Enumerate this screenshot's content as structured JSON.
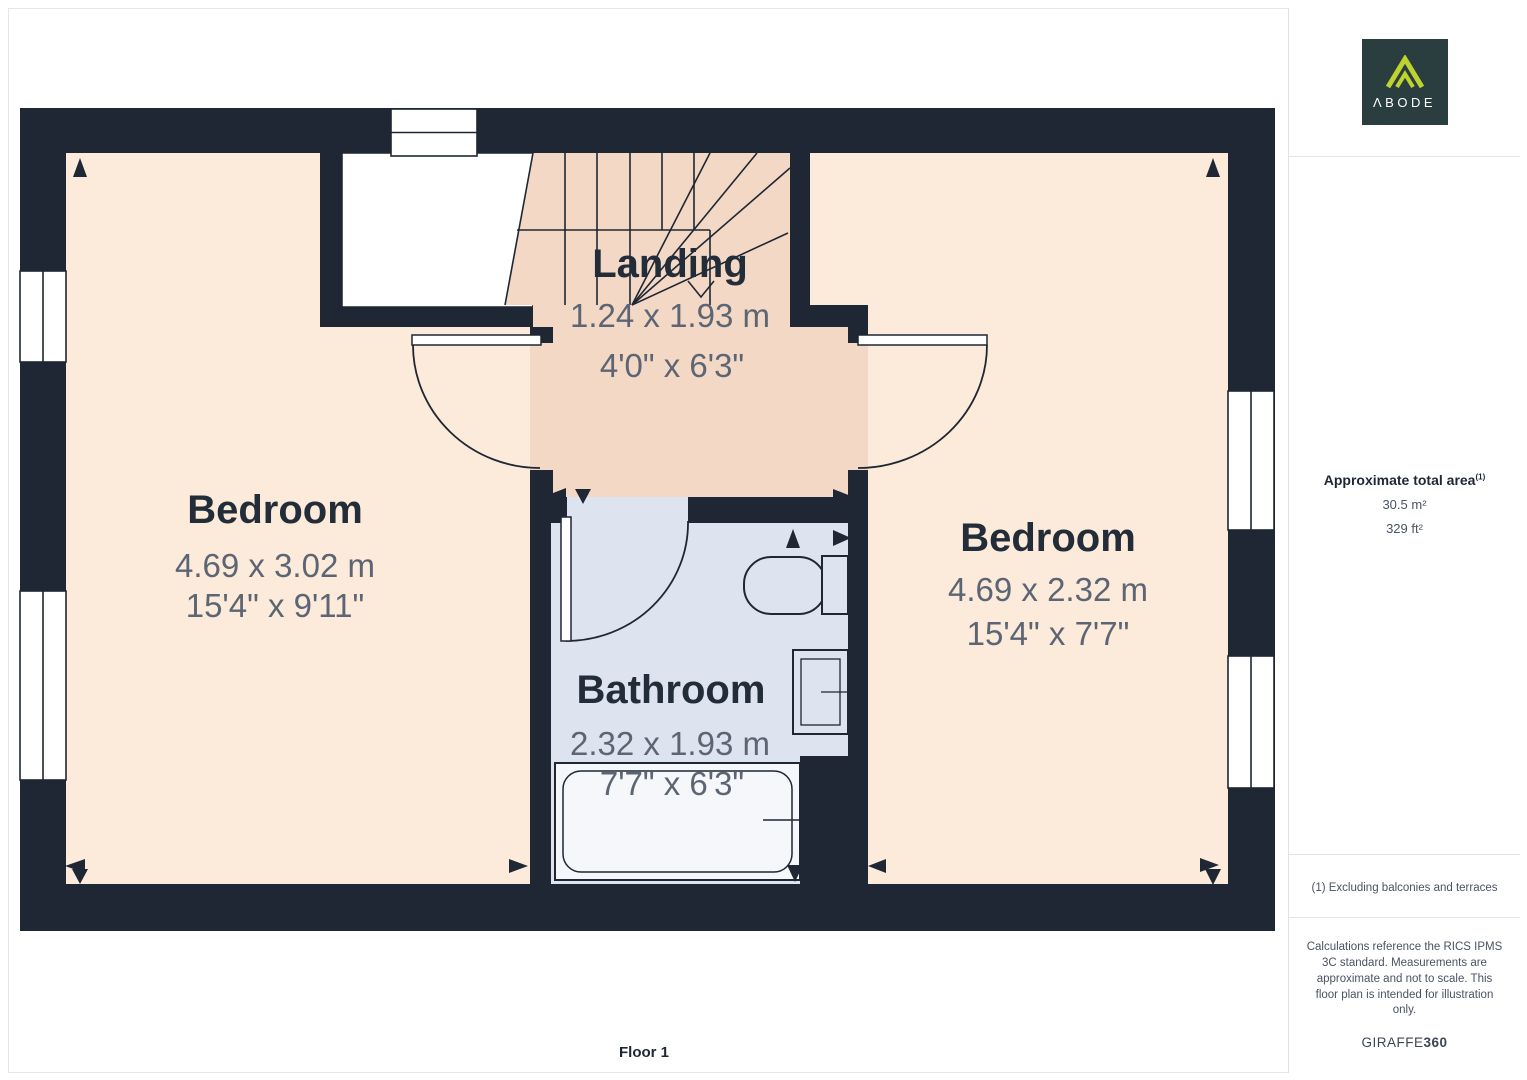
{
  "floorplan": {
    "floor_label": "Floor 1",
    "rooms": [
      {
        "name": "Bedroom",
        "dim_m": "4.69 x 3.02 m",
        "dim_ft": "15'4\" x 9'11\""
      },
      {
        "name": "Landing",
        "dim_m": "1.24 x 1.93 m",
        "dim_ft": "4'0\" x 6'3\""
      },
      {
        "name": "Bathroom",
        "dim_m": "2.32 x 1.93 m",
        "dim_ft": "7'7\" x 6'3\""
      },
      {
        "name": "Bedroom",
        "dim_m": "4.69 x 2.32 m",
        "dim_ft": "15'4\" x 7'7\""
      }
    ]
  },
  "sidebar": {
    "logo": {
      "text": "ΛBODE"
    },
    "area": {
      "heading": "Approximate total area",
      "superscript": "(1)",
      "metric": "30.5 m²",
      "imperial": "329 ft²"
    },
    "footnote": "(1) Excluding balconies and terraces",
    "disclaimer": "Calculations reference the RICS IPMS 3C standard. Measurements are approximate and not to scale. This floor plan is intended for illustration only.",
    "provider": {
      "name": "GIRAFFE",
      "suffix": "360"
    }
  },
  "colors": {
    "wall": "#1E2733",
    "bedroom_fill": "#FCEADB",
    "landing_fill": "#F4D8C6",
    "bathroom_fill": "#DEE3F0",
    "room_name_text": "#232C39",
    "dimension_text": "#5C6573",
    "logo_background": "#2B3E3F",
    "logo_chevron": "#BFD32F",
    "divider": "#E4E4E4"
  }
}
